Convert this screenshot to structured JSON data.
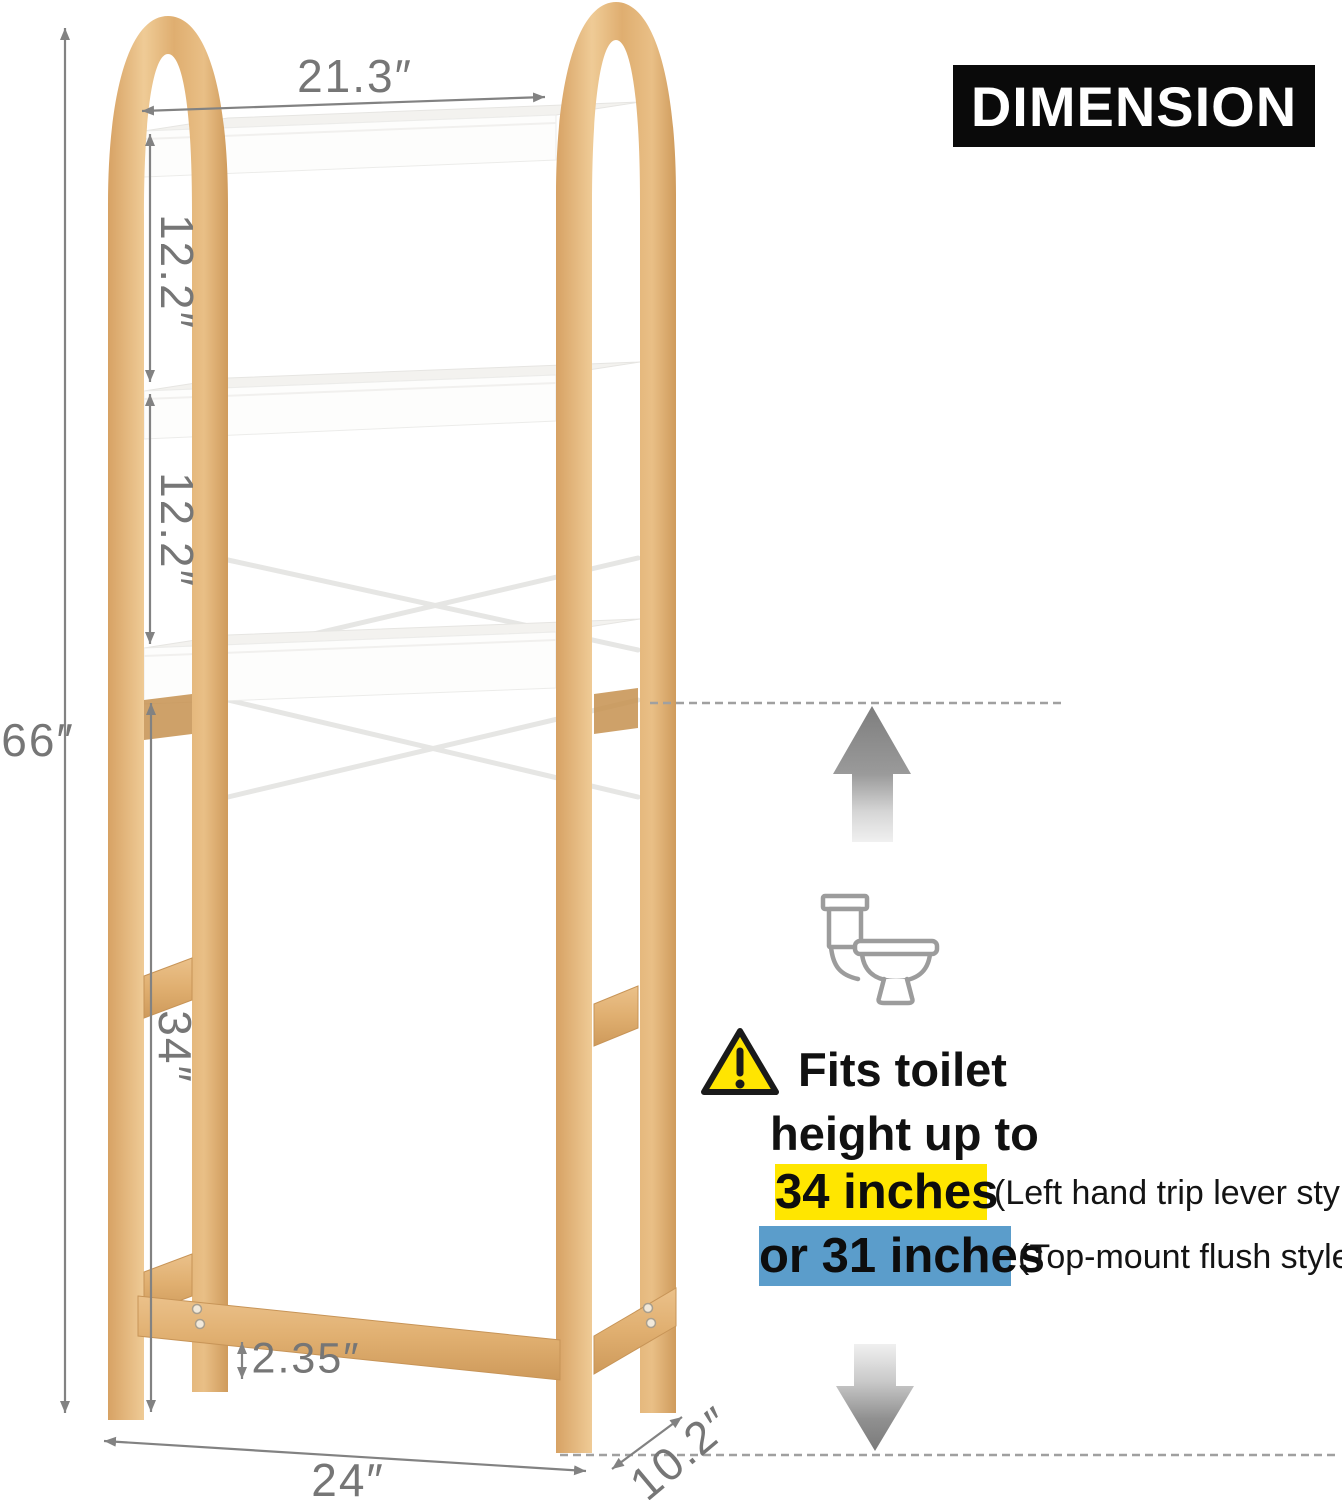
{
  "banner": {
    "title": "DIMENSION"
  },
  "measurements": {
    "top_width": "21.3″",
    "shelf_gap_upper": "12.2″",
    "shelf_gap_lower": "12.2″",
    "overall_height": "66″",
    "clearance_height": "34″",
    "foot_height": "2.35″",
    "base_width": "24″",
    "depth": "10.2″"
  },
  "callout": {
    "line1": "Fits toilet",
    "line2": "height up to",
    "option1_value": "34 inches",
    "option1_note": "(Left hand trip lever style)",
    "option2_value": "or 31 inches",
    "option2_note": "(Top-mount flush style)"
  },
  "colors": {
    "bamboo": "#E2B277",
    "shelf_white": "#FDFDFC",
    "dimension_gray": "#828282",
    "highlight_yellow": "#FFE600",
    "highlight_blue": "#5B9DCB",
    "banner_bg": "#0A0A0A",
    "banner_text": "#FFFFFF",
    "warning_yellow": "#FFE501",
    "arrow_gray": "#8C8C8C"
  },
  "icons": {
    "toilet": "toilet-outline",
    "warning": "warning-triangle",
    "up_arrow": "arrow-up",
    "down_arrow": "arrow-down"
  }
}
